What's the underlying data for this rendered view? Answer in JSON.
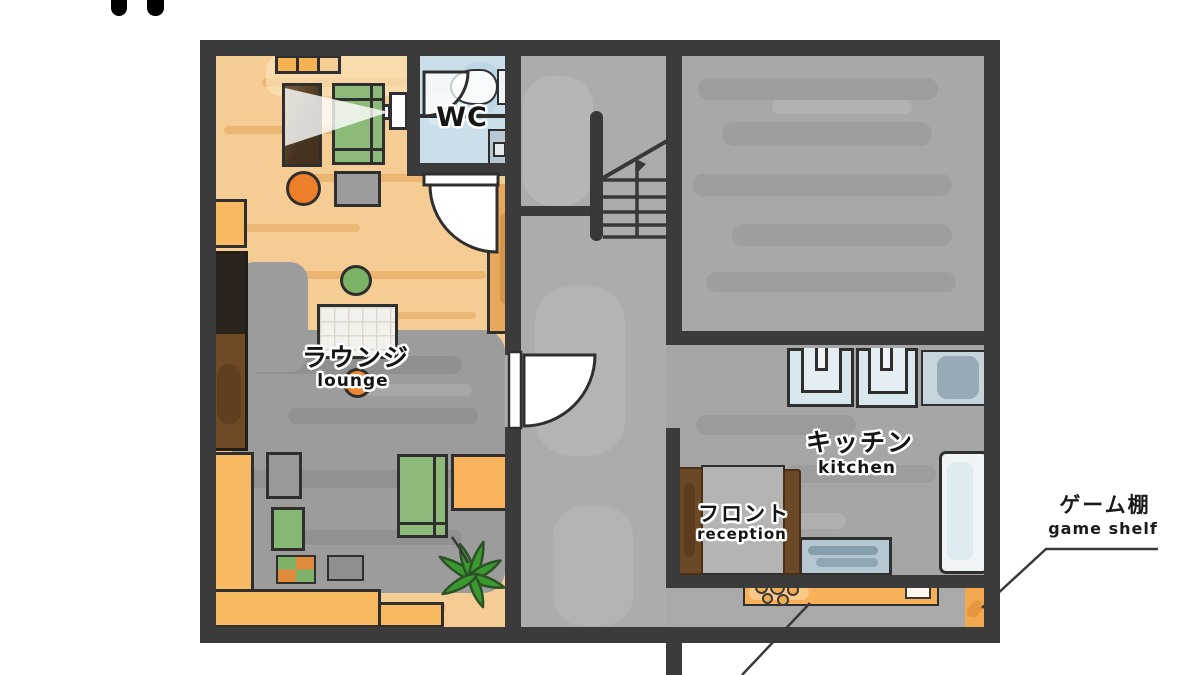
{
  "title": "guesthouse floor plan",
  "labels": {
    "wc": "WC",
    "lounge_ja": "ラウンジ",
    "lounge_en": "lounge",
    "kitchen_ja": "キッチン",
    "kitchen_en": "kitchen",
    "reception_ja": "フロント",
    "reception_en": "reception",
    "game_shelf_ja": "ゲーム棚",
    "game_shelf_en": "game shelf"
  },
  "colors": {
    "wall": "#3b3b3b",
    "wood_floor": "#f5cd94",
    "wood_streak": "#e2a256",
    "rug_gray": "#9c9c9c",
    "hall_gray": "#acacac",
    "room_gray": "#a8a8a8",
    "wc_floor": "#cadfe9",
    "accent_orange": "#f7b254",
    "accent_green": "#8cbb79",
    "sink_blue": "#d9e7ee",
    "counter_blue": "#b5c8d2",
    "desk_brown": "#6b4826"
  },
  "annotations": [
    {
      "id": "game-shelf",
      "text_ja": "ゲーム棚",
      "text_en": "game shelf",
      "points_to": "orange shelf at bottom-right of plan"
    },
    {
      "id": "stove-leader",
      "points_to": "orange counter with burners, label cut off below image"
    }
  ],
  "rooms": [
    "lounge",
    "wc",
    "hallway-with-stairs",
    "upper-right-room",
    "kitchen",
    "reception",
    "rear-passage"
  ]
}
